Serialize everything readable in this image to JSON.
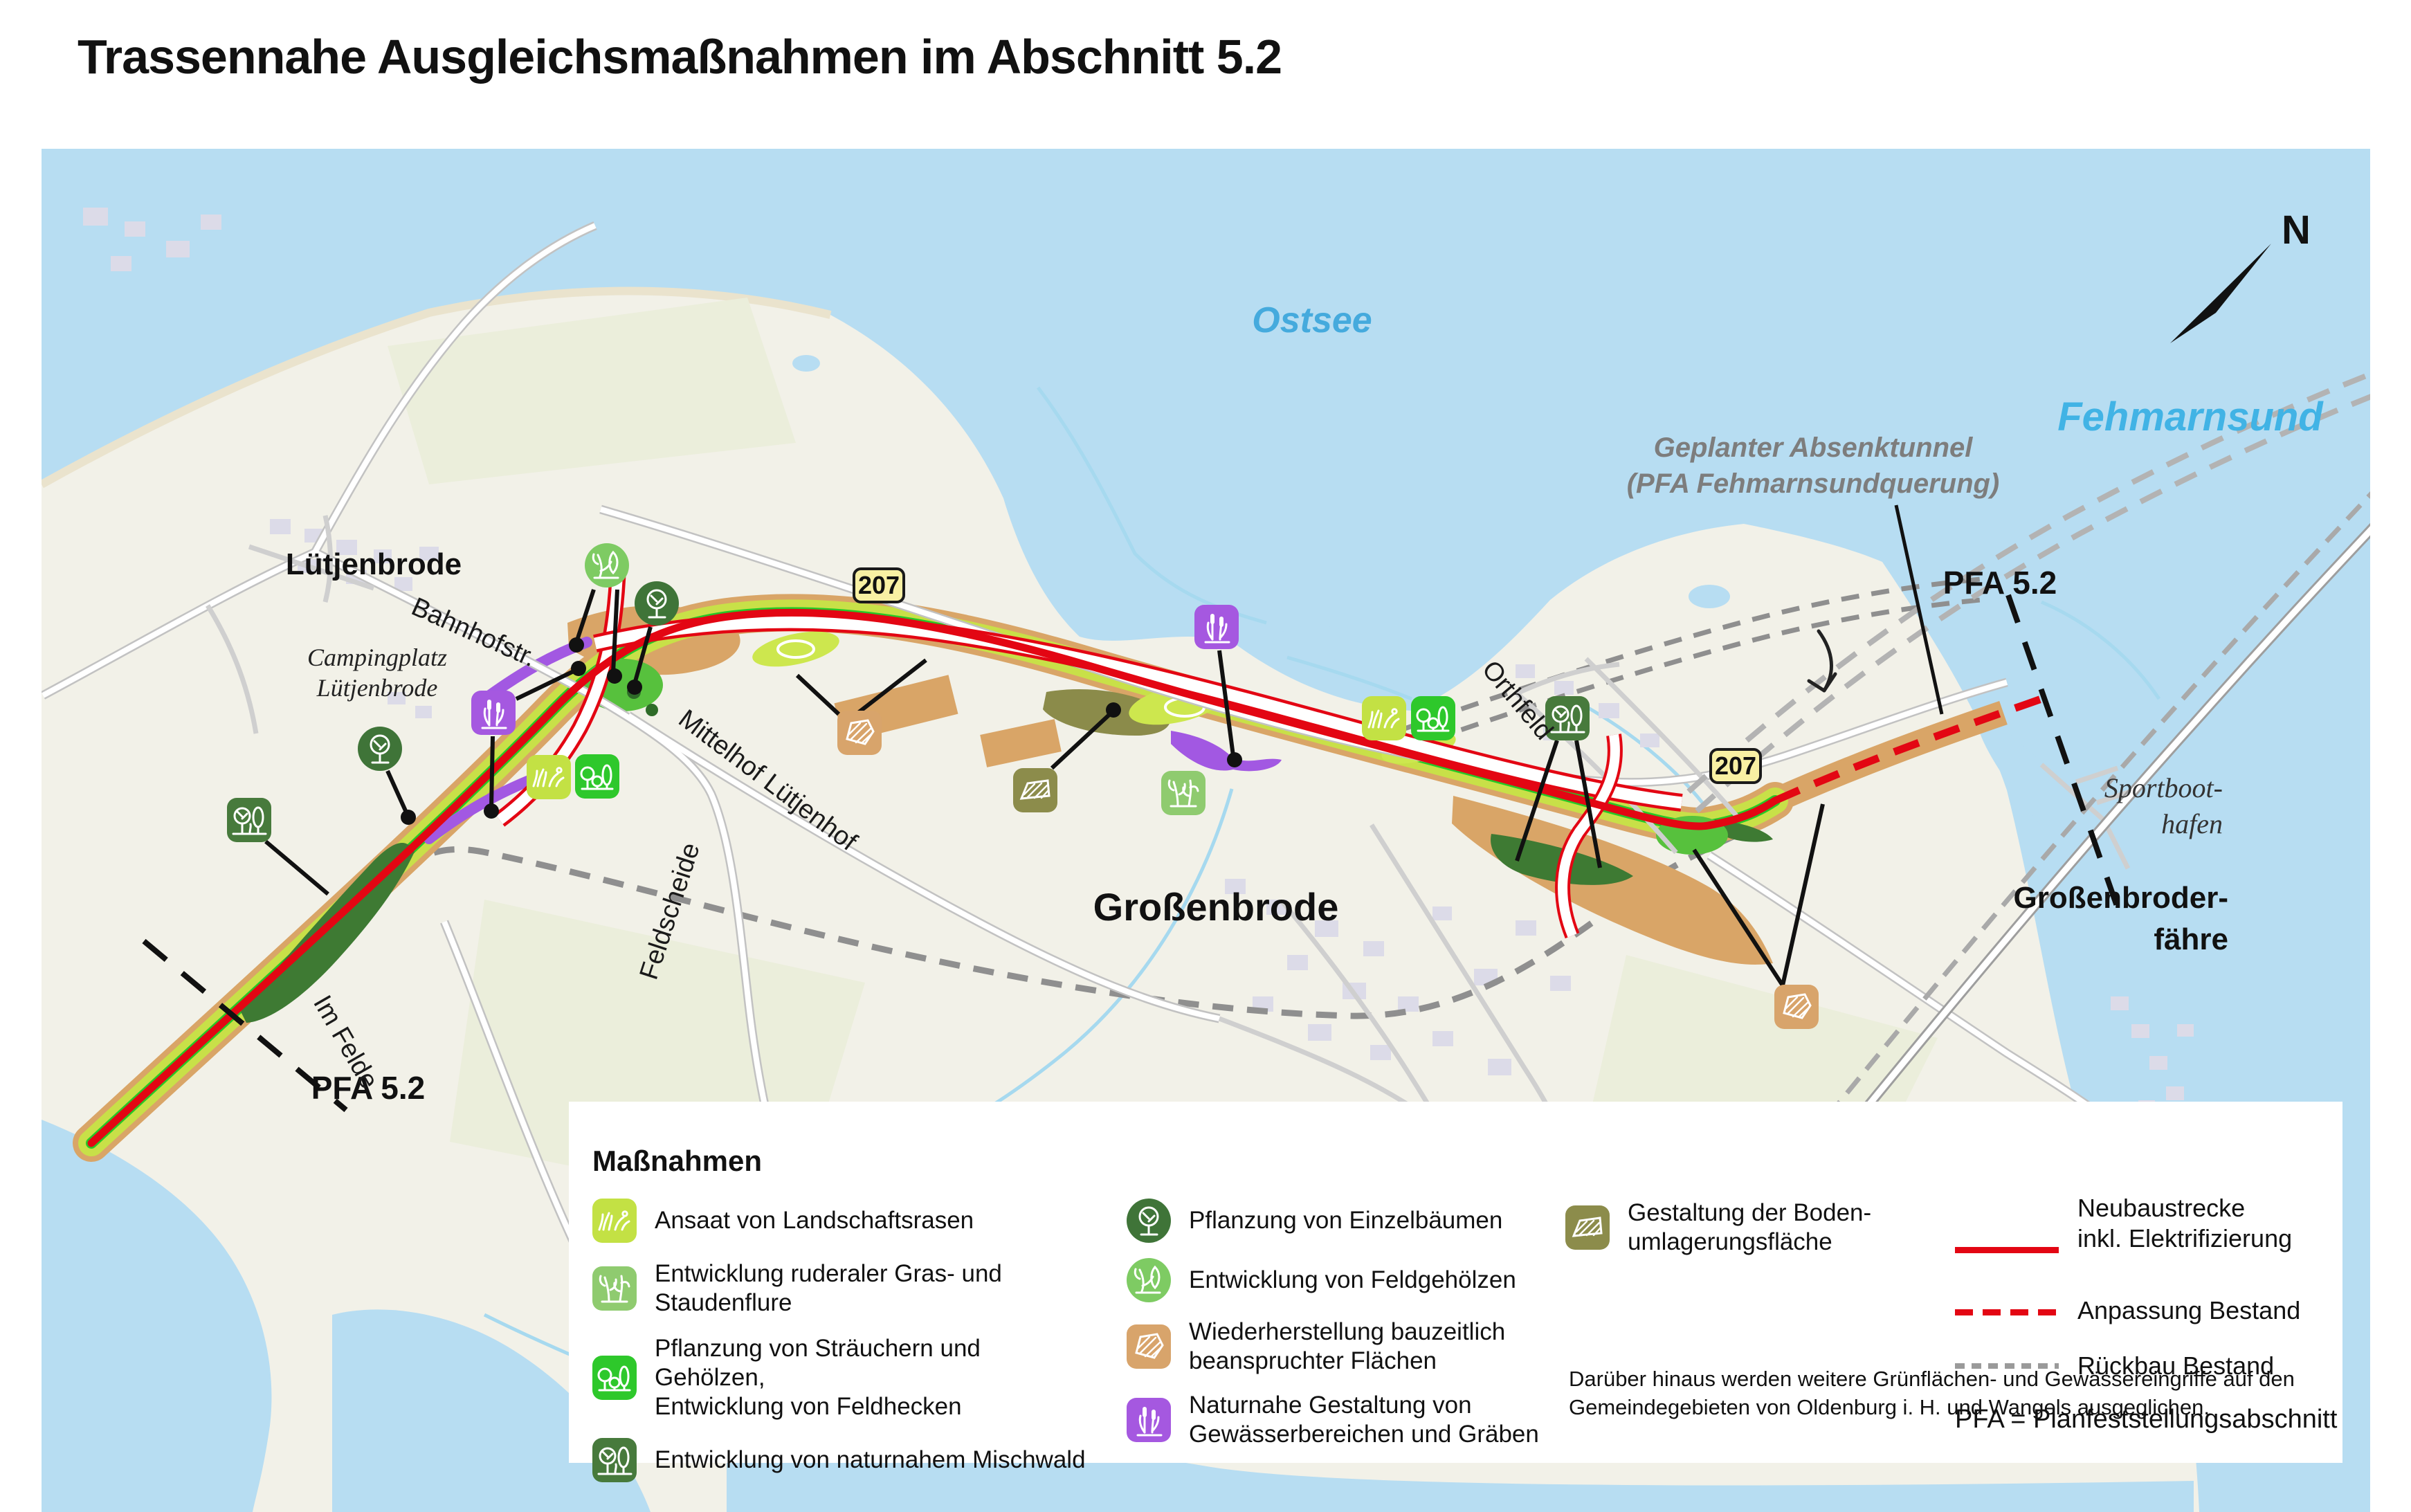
{
  "title": "Trassennahe Ausgleichsmaßnahmen im Abschnitt 5.2",
  "map": {
    "water_labels": {
      "ostsee": "Ostsee",
      "fehmarnsund": "Fehmarnsund"
    },
    "compass": {
      "north": "N"
    },
    "road_badge": "207",
    "section_labels": {
      "pfa_left": "PFA 5.2",
      "pfa_right": "PFA 5.2"
    },
    "tunnel_note": {
      "line1": "Geplanter Absenktunnel",
      "line2": "(PFA Fehmarnsundquerung)"
    },
    "towns": {
      "luetjenbrode": "Lütjenbrode",
      "grossenbrode": "Großenbrode",
      "faehre_line1": "Großenbroder-",
      "faehre_line2": "fähre"
    },
    "sites": {
      "camping_line1": "Campingplatz",
      "camping_line2": "Lütjenbrode",
      "marina_line1": "Sportboot-",
      "marina_line2": "hafen",
      "orthfeld": "Orthfeld"
    },
    "streets": {
      "bahnhofstr": "Bahnhofstr.",
      "mittelhof": "Mittelhof Lütjenhof",
      "feldscheide": "Feldscheide",
      "im_felde": "Im Felde"
    }
  },
  "legend": {
    "title": "Maßnahmen",
    "measures": [
      {
        "id": "rasen",
        "color": "#c3e144",
        "lines": [
          "Ansaat von Landschaftsrasen",
          ""
        ]
      },
      {
        "id": "stauden",
        "color": "#8fcb6f",
        "lines": [
          "Entwicklung ruderaler Gras- und",
          "Staudenflure"
        ]
      },
      {
        "id": "straeucher",
        "color": "#2ec82b",
        "lines": [
          "Pflanzung von Sträuchern und Gehölzen,",
          "Entwicklung von Feldhecken"
        ]
      },
      {
        "id": "mischwald",
        "color": "#477a3c",
        "lines": [
          "Entwicklung von naturnahem Mischwald",
          ""
        ]
      },
      {
        "id": "einzelbaeume",
        "color": "#3f7438",
        "lines": [
          "Pflanzung von Einzelbäumen",
          ""
        ]
      },
      {
        "id": "feldgehoelze",
        "color": "#7ecb63",
        "lines": [
          "Entwicklung von Feldgehölzen",
          ""
        ]
      },
      {
        "id": "bauzeitlich",
        "color": "#d8a46b",
        "lines": [
          "Wiederherstellung bauzeitlich",
          "beanspruchter Flächen"
        ]
      },
      {
        "id": "gewaesser",
        "color": "#a558e0",
        "lines": [
          "Naturnahe Gestaltung von",
          "Gewässerbereichen und Gräben"
        ]
      },
      {
        "id": "boden",
        "color": "#8c8c4b",
        "lines": [
          "Gestaltung der Boden-",
          "umlagerungsfläche"
        ]
      }
    ],
    "line_items": [
      {
        "id": "neubau",
        "lines": [
          "Neubaustrecke",
          "inkl. Elektrifizierung"
        ]
      },
      {
        "id": "anpassung",
        "lines": [
          "Anpassung Bestand",
          ""
        ]
      },
      {
        "id": "rueckbau",
        "lines": [
          "Rückbau Bestand",
          ""
        ]
      }
    ],
    "pfa_note": "PFA = Planfeststellungsabschnitt",
    "footnote": {
      "line1": "Darüber hinaus werden weitere Grünflächen- und Gewässereingriffe auf den",
      "line2": "Gemeindegebieten von Oldenburg i. H. und Wangels ausgeglichen."
    }
  },
  "colors": {
    "water": "#b7ddf2",
    "land": "#f2f1e8",
    "new_line_red": "#e30613",
    "construction_brown": "#d9a567",
    "grass_yellowgreen": "#c8e048",
    "hedge_green": "#26c826",
    "forest_darkgreen": "#3e7a33",
    "soil_olive": "#8b8b4a",
    "water_purple": "#a258e2",
    "rueckbau_gray": "#8f8f8f",
    "badge_yellow": "#f8f0a3"
  }
}
